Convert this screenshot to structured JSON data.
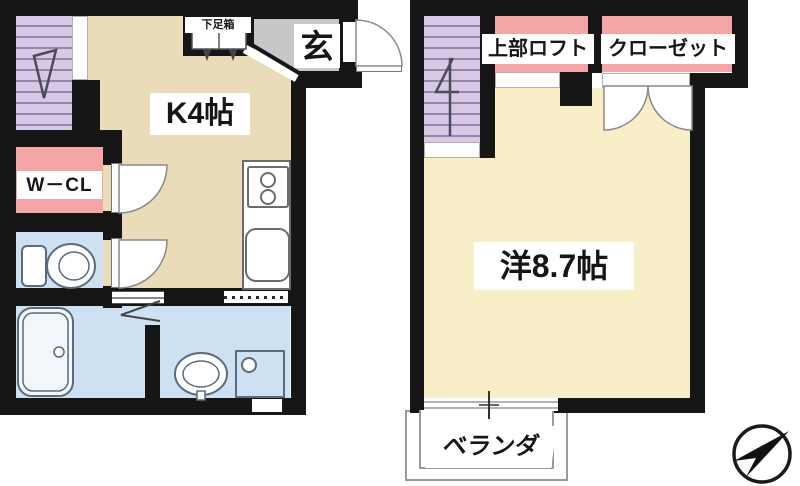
{
  "document": {
    "type": "apartment-floor-plan",
    "floors": 2
  },
  "colors": {
    "wall": "#161616",
    "kitchen": "#EADBB9",
    "room": "#F8EFC9",
    "stairs": "#D7C9E6",
    "stairline": "#9486AD",
    "pink": "#F4A6A6",
    "wet": "#CEE1F2",
    "genkan": "#C7C7C9"
  },
  "floor1": {
    "labels": {
      "shoebox": "下足箱",
      "entrance": "玄",
      "kitchen": "K4帖",
      "walk_in_closet": "W－CL"
    }
  },
  "floor2": {
    "labels": {
      "loft": "上部ロフト",
      "closet": "クローゼット",
      "western_room": "洋8.7帖",
      "veranda": "ベランダ"
    }
  }
}
